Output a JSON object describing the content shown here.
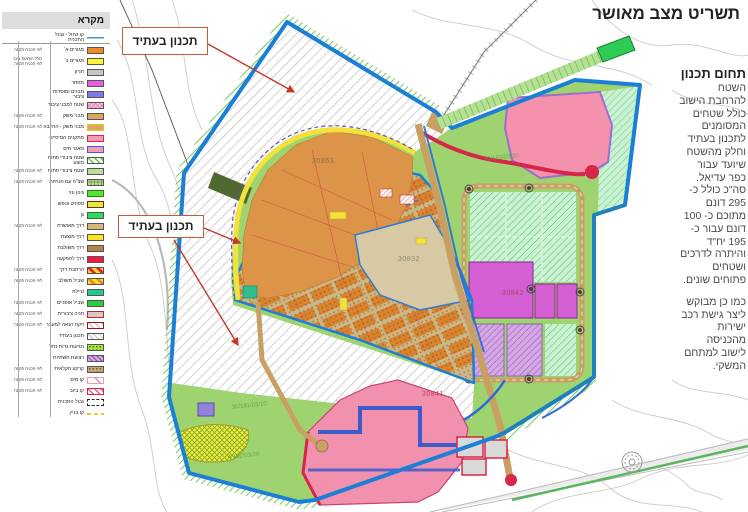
{
  "title": "תשריט מצב מאושר",
  "right_panel": {
    "heading": "תחום תכנון",
    "para1": "השטח\nלהרחבת הישוב\nכולל שטחים\nהמסומנים\nלתכנון בעתיד\nוחלק מהשטח\nשיועד עבור\nכפר עדיאל.\nסה\"כ כולל כ-\n295 דונם\nמתוכם כ- 100\nדונם עבור כ-\n195 יח\"ד\nוהיתרה לדרכים\nושטחים\nפתוחים שונים.",
    "para2": "כמו כן מבוקש\nליצר גישת רכב\nישירות\nמהכניסה\nלישוב למתחם\nהמשקי."
  },
  "legend": {
    "title": "מקרא",
    "items": [
      {
        "type": "line",
        "label": "קו כחול - גבול התכנית"
      },
      {
        "bg": "#F08A28",
        "label": "מגורים א'",
        "note": "לפי תכנית תקפה"
      },
      {
        "bg": "#FDF53B",
        "label": "מגורים ב'",
        "note": "כולל הוראות בינוי לפי תכנית תקפה"
      },
      {
        "bg": "#C6C6C6",
        "label": "חניון"
      },
      {
        "bg": "#E25FE2",
        "label": "מסחר"
      },
      {
        "bg": "#7B7BEA",
        "label": "מבנים ומוסדות ציבור"
      },
      {
        "pat": "pink-cross",
        "label": "שטח למבני ציבור"
      },
      {
        "bg": "#D9A75E",
        "label": "מבני משק",
        "note": "לפי תכנית תקפה"
      },
      {
        "bg": "#D9A75E",
        "border": "#E7C52B",
        "label": "מבני משק - הרחבה",
        "note": "לפי תכנית תקפה"
      },
      {
        "bg": "#F59BB4",
        "border": "#D6264A",
        "label": "מתקנים הנדסיים"
      },
      {
        "bg": "#F59BB4",
        "border": "#4A5BD6",
        "label": "מאגר מים"
      },
      {
        "pat": "green-diag",
        "label": "שטח ציבורי פתוח מוצע"
      },
      {
        "bg": "#BCDF96",
        "label": "שטח ציבורי פתוח",
        "note": "לפי תכנית תקפה"
      },
      {
        "pat": "green-grid",
        "label": "שצ\"פ עם הנחיות",
        "note": "לפי תכנית תקפה"
      },
      {
        "bg": "#52E62F",
        "border": "#2E7D1E",
        "label": "גינון ונוי"
      },
      {
        "bg": "#D8EF34",
        "border": "#8B1A1A",
        "label": "ספורט ונופש"
      },
      {
        "bg": "#2EDC55",
        "label": "גן"
      },
      {
        "bg": "#D6B877",
        "label": "דרך מאושרת",
        "note": "לפי תכנית תקפה"
      },
      {
        "bg": "#FFE01E",
        "label": "דרך מוצעת"
      },
      {
        "bg": "#B5854B",
        "label": "דרך משולבת"
      },
      {
        "bg": "#ED1B43",
        "label": "דרך להפקעה"
      },
      {
        "pat": "red-yellow",
        "label": "הרחבת דרך",
        "note": "לפי תכנית תקפה"
      },
      {
        "pat": "orange-yellow",
        "label": "שביל משולב",
        "note": "לפי תכנית תקפה"
      },
      {
        "bg": "#27C795",
        "label": "טיילת"
      },
      {
        "bg": "#2ECC3B",
        "label": "שביל אופניים",
        "note": "לפי תכנית תקפה"
      },
      {
        "bg": "#D2CACA",
        "border": "#C2242C",
        "label": "חניה ציבורית",
        "note": "לפי תכנית תקפה"
      },
      {
        "pat": "pink-thin",
        "border": "#8B1A1A",
        "label": "זיקת הנאה למעבר",
        "note": "לפי תכנית תקפה"
      },
      {
        "pat": "gray-thin",
        "label": "תכנון בעתיד"
      },
      {
        "pat": "dots-green",
        "label": "נטיעות גדות נחל"
      },
      {
        "pat": "purple-diag",
        "label": "רצועת תשתיות"
      },
      {
        "pat": "dots-tan",
        "label": "קרקע חקלאית",
        "note": "לפי תכנית תקפה"
      },
      {
        "pat": "thin-line",
        "border": "#E3A0B4",
        "label": "קו מים",
        "note": "לפי תכנית תקפה"
      },
      {
        "pat": "pink-diag",
        "border": "#D6264A",
        "label": "קו ביוב",
        "note": "לפי תכנית תקפה"
      },
      {
        "type": "corners",
        "label": "גבול התכנית"
      },
      {
        "type": "ydash",
        "label": "קו בניין"
      }
    ]
  },
  "map": {
    "future_label": "תכנון בעתיד",
    "parcel_labels": [
      {
        "text": "30863",
        "x": 200,
        "y": 163,
        "color": "#8a7050"
      },
      {
        "text": "30832",
        "x": 286,
        "y": 261,
        "color": "#8a8878"
      },
      {
        "text": "30842",
        "x": 390,
        "y": 295,
        "color": "#a04a5a"
      },
      {
        "text": "30841",
        "x": 310,
        "y": 396,
        "color": "#c2425a"
      }
    ],
    "ref_labels": [
      {
        "text": "30/181/03/10",
        "x": 120,
        "y": 409
      },
      {
        "text": "4/182/03/20",
        "x": 116,
        "y": 459
      },
      {
        "text": "30/182/03/20",
        "x": 372,
        "y": 161
      }
    ]
  },
  "colors": {
    "blue": "#1B7FD6",
    "bandgreen": "#57C23E",
    "plangreen": "#9FD36F",
    "resorange": "#DC9448",
    "lotorange": "#D9832F",
    "roadtan": "#C9A063",
    "pink": "#F291AE",
    "reservoirpink": "#F492AE",
    "magenta": "#D45FD4",
    "mint": "#C8F2D2",
    "crimson": "#D6264A",
    "chartreuse": "#CCF23C",
    "boxborder": "#C25B3A",
    "arrowred": "#C0392B"
  }
}
